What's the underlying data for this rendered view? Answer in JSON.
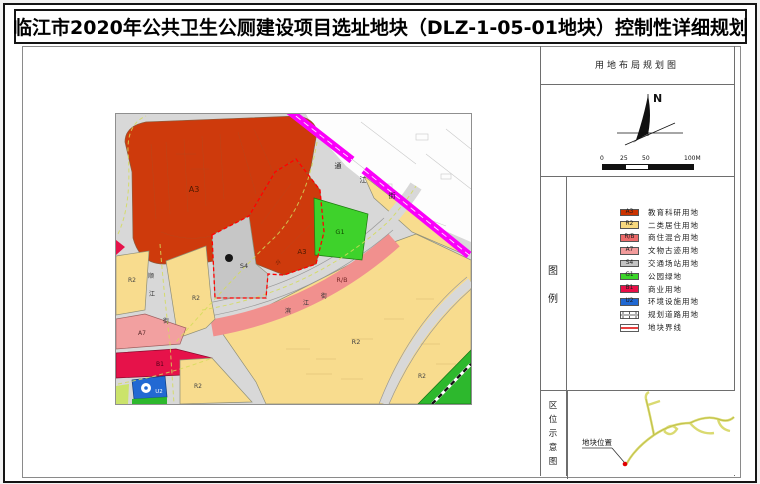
{
  "title": "临江市2020年公共卫生公厕建设项目选址地块（DLZ-1-05-01地块）控制性详细规划",
  "panel": {
    "header": "用地布局规划图",
    "north_label": "N",
    "scale": {
      "ticks": [
        "0",
        "25",
        "50",
        "100M"
      ]
    },
    "legend_title": "图例",
    "legend": [
      {
        "code": "A3",
        "color": "#cc3300",
        "label": "教育科研用地"
      },
      {
        "code": "R2",
        "color": "#f7d97f",
        "label": "二类居住用地"
      },
      {
        "code": "R/B",
        "color": "#ed6a6a",
        "label": "商住混合用地"
      },
      {
        "code": "A7",
        "color": "#f29b9b",
        "label": "文物古迹用地"
      },
      {
        "code": "S4",
        "color": "#c4c4c4",
        "label": "交通场站用地"
      },
      {
        "code": "G1",
        "color": "#3bd629",
        "label": "公园绿地"
      },
      {
        "code": "B1",
        "color": "#e80f47",
        "label": "商业用地"
      },
      {
        "code": "U2",
        "color": "#2068d2",
        "label": "环境设施用地"
      },
      {
        "code": "",
        "color": "#ffffff",
        "label": "规划道路用地",
        "type": "road"
      },
      {
        "code": "",
        "color": "#ffffff",
        "label": "地块界线",
        "type": "boundary"
      }
    ],
    "location_title": "区位示意图",
    "location_label": "地块位置"
  },
  "colors": {
    "A3": "#ce3a0c",
    "R2": "#f8dc8e",
    "RB": "#f1908e",
    "A7": "#f2a0a0",
    "S4": "#c6c6c6",
    "G1": "#3ed22b",
    "B1": "#e6124a",
    "U2": "#2269d3",
    "green_strip": "#2db82d",
    "light_green": "#cbe36b",
    "road_planned": "#fa00fa",
    "plot_boundary": "#ff0000",
    "road_base": "#d8d8d8"
  },
  "map": {
    "labels": [
      {
        "text": "A3",
        "x": 78,
        "y": 78,
        "size": 8,
        "color": "#4d1a00"
      },
      {
        "text": "A3",
        "x": 186,
        "y": 140,
        "size": 7,
        "color": "#4d1a00"
      },
      {
        "text": "G1",
        "x": 224,
        "y": 120,
        "size": 6.5,
        "color": "#114d00"
      },
      {
        "text": "S4",
        "x": 128,
        "y": 154,
        "size": 6.5,
        "color": "#333333"
      },
      {
        "text": "R/B",
        "x": 226,
        "y": 168,
        "size": 6.5,
        "color": "#7a2a2a"
      },
      {
        "text": "R2",
        "x": 16,
        "y": 168,
        "size": 6,
        "color": "#444444"
      },
      {
        "text": "R2",
        "x": 80,
        "y": 186,
        "size": 6,
        "color": "#444444"
      },
      {
        "text": "R2",
        "x": 82,
        "y": 274,
        "size": 6,
        "color": "#444444"
      },
      {
        "text": "R2",
        "x": 240,
        "y": 230,
        "size": 6.5,
        "color": "#444444"
      },
      {
        "text": "R2",
        "x": 306,
        "y": 264,
        "size": 6,
        "color": "#444444"
      },
      {
        "text": "A7",
        "x": 26,
        "y": 221,
        "size": 6,
        "color": "#5a2a2a"
      },
      {
        "text": "B1",
        "x": 44,
        "y": 252,
        "size": 6,
        "color": "#4d0015"
      },
      {
        "text": "U2",
        "x": 43,
        "y": 279,
        "size": 5.5,
        "color": "#ffffff"
      },
      {
        "text": "通",
        "x": 222,
        "y": 54,
        "size": 7,
        "color": "#222222"
      },
      {
        "text": "江",
        "x": 247,
        "y": 68,
        "size": 7,
        "color": "#222222"
      },
      {
        "text": "街",
        "x": 276,
        "y": 84,
        "size": 7,
        "color": "#222222"
      },
      {
        "text": "顺",
        "x": 35,
        "y": 164,
        "size": 6,
        "color": "#333333"
      },
      {
        "text": "江",
        "x": 36,
        "y": 182,
        "size": 6,
        "color": "#333333"
      },
      {
        "text": "街",
        "x": 50,
        "y": 209,
        "size": 6,
        "color": "#333333"
      },
      {
        "text": "滨",
        "x": 172,
        "y": 199,
        "size": 6,
        "color": "#333333"
      },
      {
        "text": "江",
        "x": 190,
        "y": 191,
        "size": 6,
        "color": "#333333"
      },
      {
        "text": "街",
        "x": 208,
        "y": 184,
        "size": 6,
        "color": "#333333"
      },
      {
        "text": "小",
        "x": 162,
        "y": 150,
        "size": 5,
        "color": "#4d1a00"
      }
    ]
  }
}
